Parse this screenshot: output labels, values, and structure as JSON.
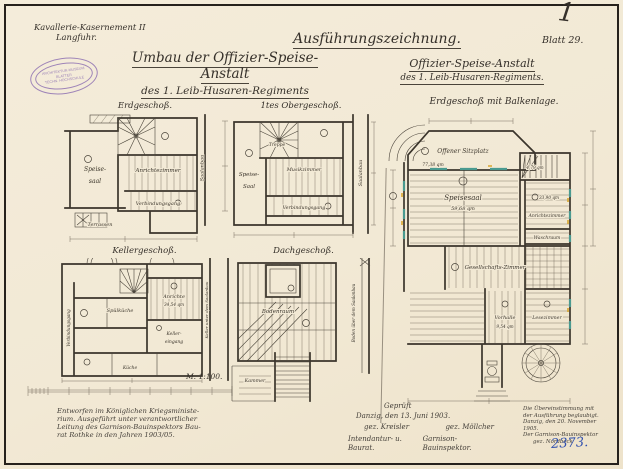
{
  "page": {
    "corner_mark": "1",
    "inventory_no": "2373.",
    "paper_color": "#f2e9d5",
    "ink_color": "#3a342b",
    "accent_blue": "#2f4fae",
    "accent_teal": "#4a9a90",
    "accent_yellow": "#d9a62e",
    "stamp_color": "#8a6bb0"
  },
  "header": {
    "location_line1": "Kavallerie-Kasernement II",
    "location_line2": "Langfuhr.",
    "stamp": {
      "line1": "ARCHITEKTUR-MUSEUM",
      "line2": "BLATTER",
      "line3": "TECHN. HOCHSCHULE"
    },
    "main_title_line1": "Umbau der Offizier-Speise-Anstalt",
    "main_title_line2": "des 1. Leib-Husaren-Regiments",
    "drawing_type": "Ausführungszeichnung.",
    "right_title_line1": "Offizier-Speise-Anstalt",
    "right_title_line2": "des 1. Leib-Husaren-Regiments.",
    "sheet_no": "Blatt 29."
  },
  "plans": {
    "erdgeschoss": {
      "title": "Erdgeschoß.",
      "speisesaal_line1": "Speise-",
      "speisesaal_line2": "saal",
      "anrichtezimmer": "Anrichtezimmer",
      "verbindungsgang": "Verbindungsgang",
      "terrasse": "Terrassen",
      "side_label": "Saalanbau"
    },
    "obergeschoss": {
      "title": "1tes Obergeschoß.",
      "treppe": "Treppe",
      "speisesaal_line1": "Speise-",
      "speisesaal_line2": "Saal",
      "musikzimmer": "Musikzimmer",
      "verbindungsgang": "Verbindungsgang",
      "side_label": "Saalanbau"
    },
    "kellergeschoss": {
      "title": "Kellergeschoß.",
      "spuelkueche": "Spülküche",
      "anrichte": "Anrichte",
      "anrichte_area": "34,54 qm",
      "keller_line1": "Keller-",
      "keller_line2": "eingang",
      "kueche": "Küche",
      "gang_label": "Verbindungsgang",
      "side_label": "Keller unter dem Saalanbau"
    },
    "dachgeschoss": {
      "title": "Dachgeschoß.",
      "bodenraum": "Bodenraum",
      "kammer": "Kammer",
      "side_label": "Boden über dem Saalanbau"
    },
    "hauptplan": {
      "title": "Erdgeschoß mit Balkenlage.",
      "sitzplatz": "Offener Sitzplatz",
      "sitzplatz_area": "77,38 qm",
      "speisesaal": "Speisesaal",
      "speisesaal_area": "59,68 qm",
      "treppe_area": "4,79 qm",
      "anricht_area": "33,90 qm",
      "anrichtezimmer": "Anrichtezimmer",
      "waschraum": "Waschraum",
      "gesellschaftszimmer": "Gesellschafts-Zimmer",
      "vorhalle": "Vorhalle",
      "vorhalle_area": "9,54 qm",
      "lesezimmer": "Lesezimmer"
    }
  },
  "scale": {
    "label": "M. 1:100."
  },
  "notes": {
    "left": [
      "Entworfen im Königlichen Kriegsministe-",
      "rium. Ausgeführt unter verantwortlicher",
      "Leitung des Garnison-Bauinspektors Bau-",
      "rat Rothke in den Jahren 1903/05."
    ],
    "center": {
      "line1": "Geprüft",
      "line2": "Danzig, den 13. Juni 1903.",
      "sig_left": "gez. Kreisler",
      "sig_right": "gez. Möllcher",
      "role_left": "Intendantur- u. Baurat.",
      "role_right": "Garnison-Bauinspektor."
    },
    "right": [
      "Die Übereinstimmung mit",
      "der Ausführung beglaubigt.",
      "Danzig, den 20. November 1905.",
      "Der Garnison-Bauinspektor",
      "gez. Nordbeck"
    ]
  }
}
